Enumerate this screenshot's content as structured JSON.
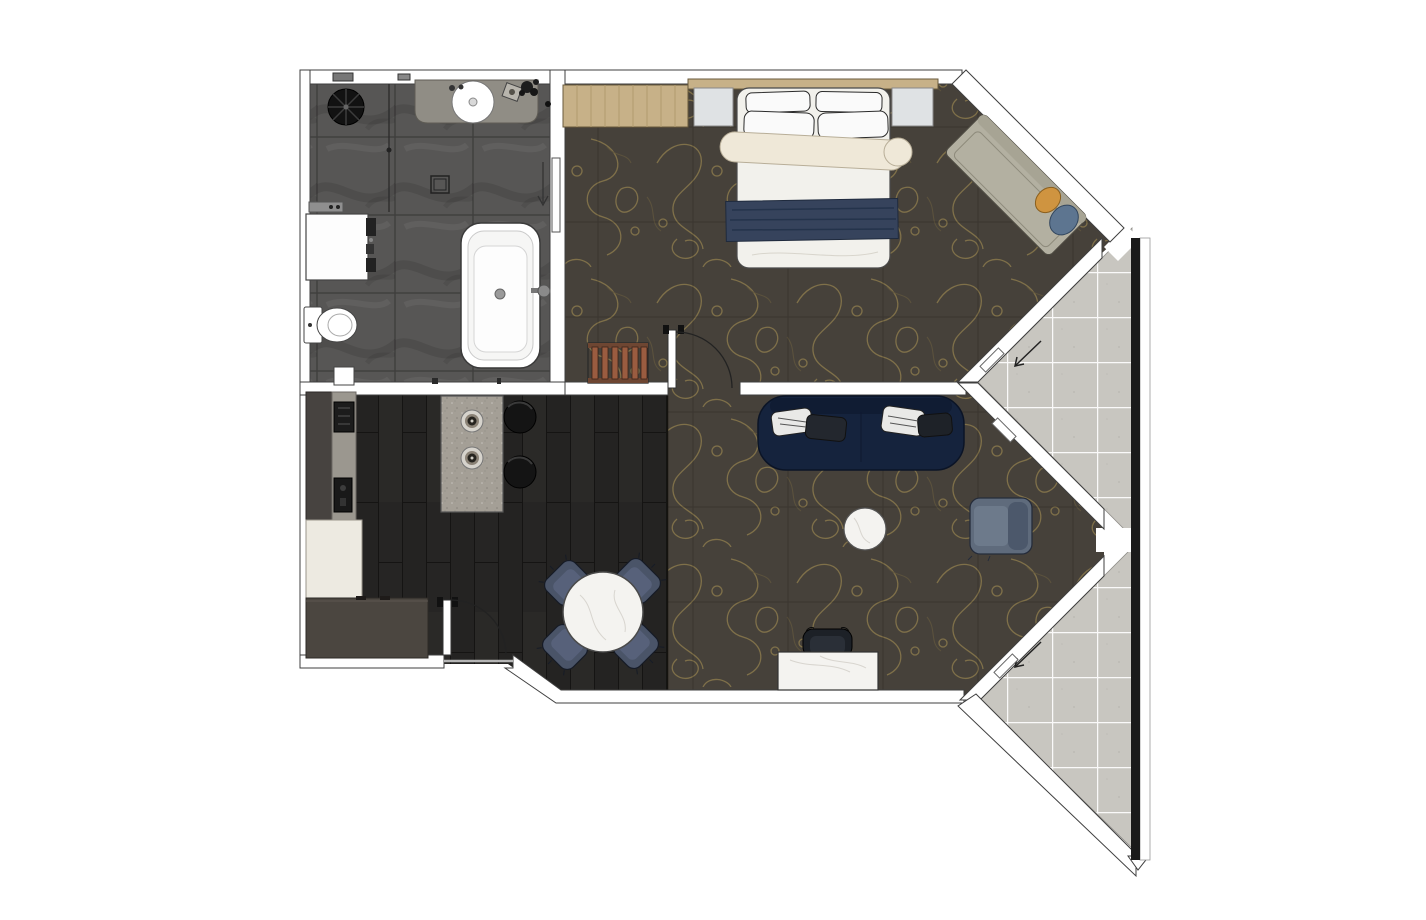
{
  "canvas": {
    "width": 1426,
    "height": 920,
    "background": "#ffffff"
  },
  "palette": {
    "wall_fill": "#ffffff",
    "wall_outline": "#3f3f3f",
    "bath_tile": "#575655",
    "vanity_stone": "#908d85",
    "carpet_base": "#46413a",
    "carpet_motif": "#8d7b4c",
    "wood_floor": "#242322",
    "corridor_tile": "#c8c6c0",
    "marble": "#f4f3f0",
    "sofa": "#15233d",
    "armchair": "#5f6b7c",
    "dining_chair": "#4a5468",
    "stool": "#141414",
    "island_stone": "#a49f96",
    "wood_furniture": "#c7b188",
    "bedding_white": "#f2f1ec",
    "cream_blanket": "#efe8d8",
    "navy_throw": "#36435c",
    "nightstand": "#dfe2e4",
    "daybed": "#b3b0a1",
    "pillow_orange": "#cf9440",
    "pillow_blue": "#5d7590",
    "luggage_wood": "#9a5c40",
    "cream_cabinet": "#edeae1",
    "taupe_closet": "#4b4640",
    "fixture_white": "#ffffff"
  },
  "rooms": {
    "bathroom": {
      "floor": "dark-gray-stone-tile",
      "furniture": [
        "rain-shower",
        "glass-partition",
        "vanity-counter",
        "round-basin",
        "wall-shelf",
        "storage-unit",
        "toilet",
        "freestanding-bathtub",
        "floor-drain",
        "sliding-door"
      ]
    },
    "bedroom": {
      "floor": "patterned-carpet",
      "furniture": [
        "wardrobe",
        "headboard",
        "nightstand-left",
        "nightstand-right",
        "double-bed",
        "pillows",
        "cream-blanket-roll",
        "navy-throw",
        "luggage-rack",
        "daybed",
        "daybed-cushions",
        "swing-door"
      ]
    },
    "living_room": {
      "floor": "patterned-carpet",
      "furniture": [
        "sofa",
        "sofa-cushions",
        "coffee-table",
        "armchair",
        "desk",
        "desk-chair"
      ]
    },
    "kitchen_dining": {
      "floor": "dark-wood-plank",
      "furniture": [
        "wall-counter",
        "cooktop-appliance",
        "counter-sink",
        "tall-cabinet",
        "entry-closet",
        "kitchen-island",
        "island-burners",
        "bar-stool-1",
        "bar-stool-2",
        "dining-table",
        "dining-chairs",
        "entry-door"
      ]
    },
    "corridors": {
      "floor": "light-gray-tile",
      "elements": [
        "upper-vestibule",
        "lower-vestibule",
        "entry-arrow-upper",
        "entry-arrow-lower",
        "sliding-panels"
      ]
    }
  }
}
